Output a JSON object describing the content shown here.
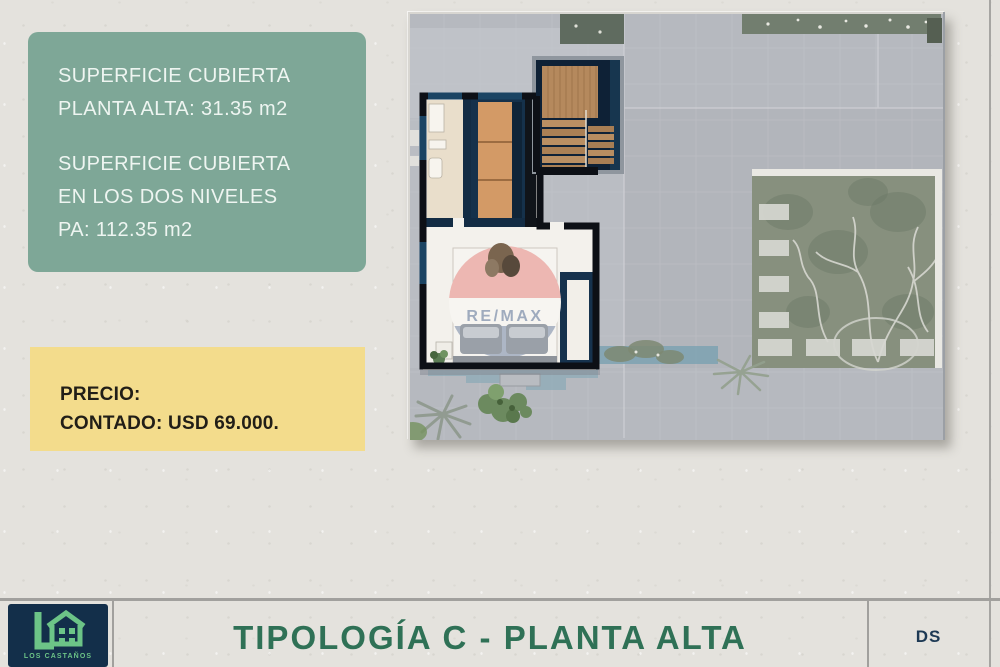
{
  "info_box": {
    "line1": "SUPERFICIE CUBIERTA",
    "line2": "PLANTA ALTA: 31.35 m2",
    "line3": "SUPERFICIE CUBIERTA",
    "line4": "EN LOS DOS NIVELES",
    "line5": "PA: 112.35 m2"
  },
  "price_box": {
    "label": "PRECIO:",
    "value": "CONTADO: USD 69.000."
  },
  "floor_plan": {
    "watermark": "RE/MAX"
  },
  "footer": {
    "logo_text": "LOS CASTAÑOS",
    "title": "TIPOLOGÍA C - PLANTA ALTA",
    "initials": "DS"
  },
  "colors": {
    "paper_background": "#e4e2dd",
    "info_box_green": "#7ea797",
    "price_box_yellow": "#f3dc8c",
    "title_green": "#2f7156",
    "logo_navy": "#132f4a",
    "logo_green": "#6cc487",
    "initials_navy": "#1d3954",
    "plan_base_gray": "#b6b9bf",
    "unit_wall_black": "#0d1016",
    "wood_stairs": "#b5895d",
    "wardrobe_orange": "#d39a66",
    "pool_teal": "#7da2b2",
    "watermark_pink": "#edb7b2"
  }
}
